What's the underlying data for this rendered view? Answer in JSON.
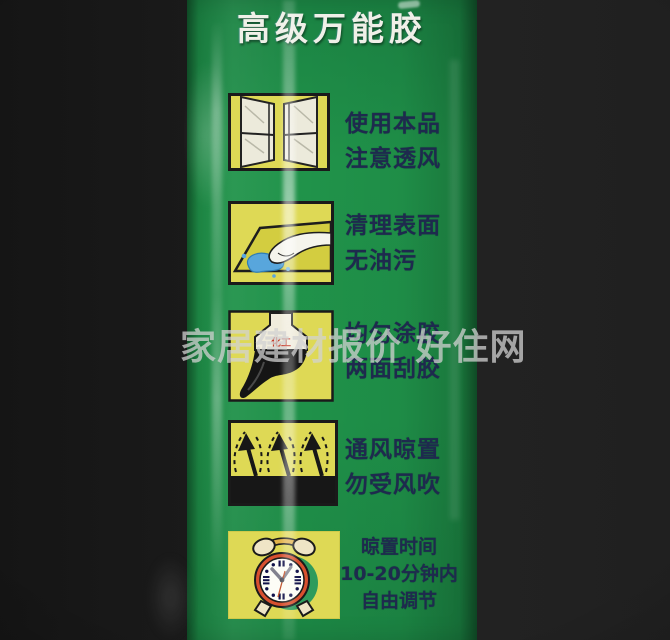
{
  "photo": {
    "watermark": "家居建材报价 好住网"
  },
  "label": {
    "title": "高级万能胶",
    "steps": [
      {
        "icon": "open-window",
        "lines": [
          "使用本品",
          "注意透风"
        ]
      },
      {
        "icon": "wipe-surface-clean",
        "lines": [
          "清理表面",
          "无油污"
        ]
      },
      {
        "icon": "glue-brush",
        "icon_text": "化工",
        "lines": [
          "均匀涂胶",
          "两面刮胶"
        ]
      },
      {
        "icon": "ventilate-arrows",
        "lines": [
          "通风晾置",
          "勿受风吹"
        ]
      },
      {
        "icon": "alarm-clock",
        "lines": [
          "晾置时间",
          "10-20分钟内",
          "自由调节"
        ]
      }
    ],
    "colors": {
      "label_green": "#1e8c47",
      "icon_yellow": "#ded955",
      "step_text_navy": "#1e2a4e",
      "title_white": "#f0f0e8",
      "watermark_gray": "#d2d2d2",
      "background_black": "#1b1b1b",
      "clock_red": "#d8502f",
      "splash_blue": "#58a6dc"
    }
  }
}
